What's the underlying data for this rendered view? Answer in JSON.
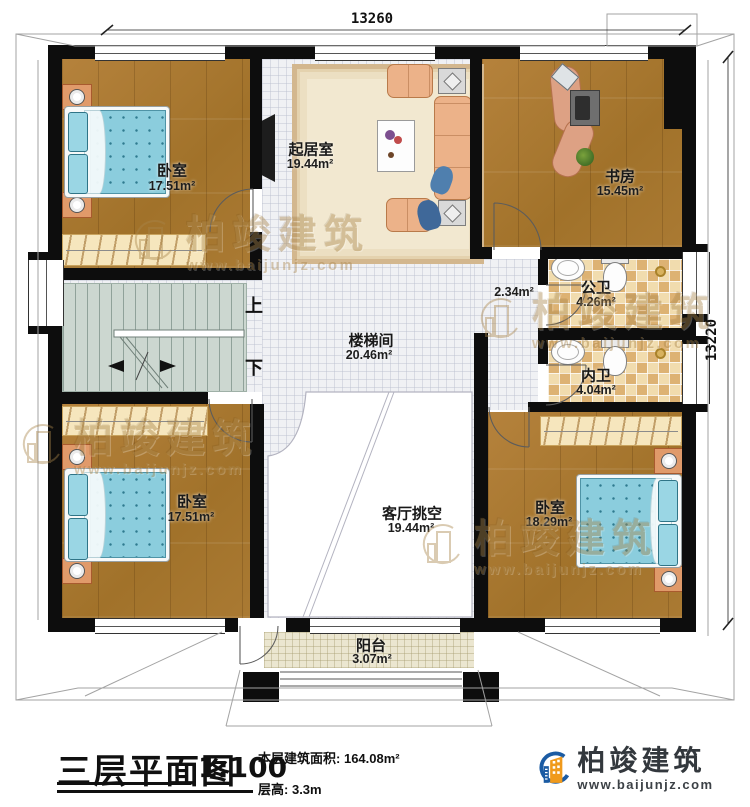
{
  "plan": {
    "dim_top": "13260",
    "dim_right": "13220",
    "rooms": {
      "bedroom_tl": {
        "name": "卧室",
        "area": "17.51m²"
      },
      "living": {
        "name": "起居室",
        "area": "19.44m²"
      },
      "study": {
        "name": "书房",
        "area": "15.45m²"
      },
      "corridor": {
        "area": "2.34m²"
      },
      "public_bath": {
        "name": "公卫",
        "area": "4.26m²"
      },
      "private_bath": {
        "name": "内卫",
        "area": "4.04m²"
      },
      "stairwell": {
        "name": "楼梯间",
        "area": "20.46m²"
      },
      "void": {
        "name": "客厅挑空",
        "area": "19.44m²"
      },
      "bedroom_bl": {
        "name": "卧室",
        "area": "17.51m²"
      },
      "bedroom_br": {
        "name": "卧室",
        "area": "18.29m²"
      },
      "balcony": {
        "name": "阳台",
        "area": "3.07m²"
      }
    },
    "stairs": {
      "up": "上",
      "down": "下"
    }
  },
  "title_block": {
    "title": "三层平面图",
    "scale": "1:100",
    "area_label": "本层建筑面积:",
    "area_value": "164.08m²",
    "height_label": "层高:",
    "height_value": "3.3m"
  },
  "branding": {
    "name": "柏竣建筑",
    "url": "www.baijunjz.com"
  },
  "colors": {
    "wall": "#0d0d0d",
    "wood": "#aa7a33",
    "accent_blue": "#1b5ba3",
    "accent_orange": "#f09a1c",
    "bed": "#8bcddd",
    "watermark": "#a9854a"
  }
}
